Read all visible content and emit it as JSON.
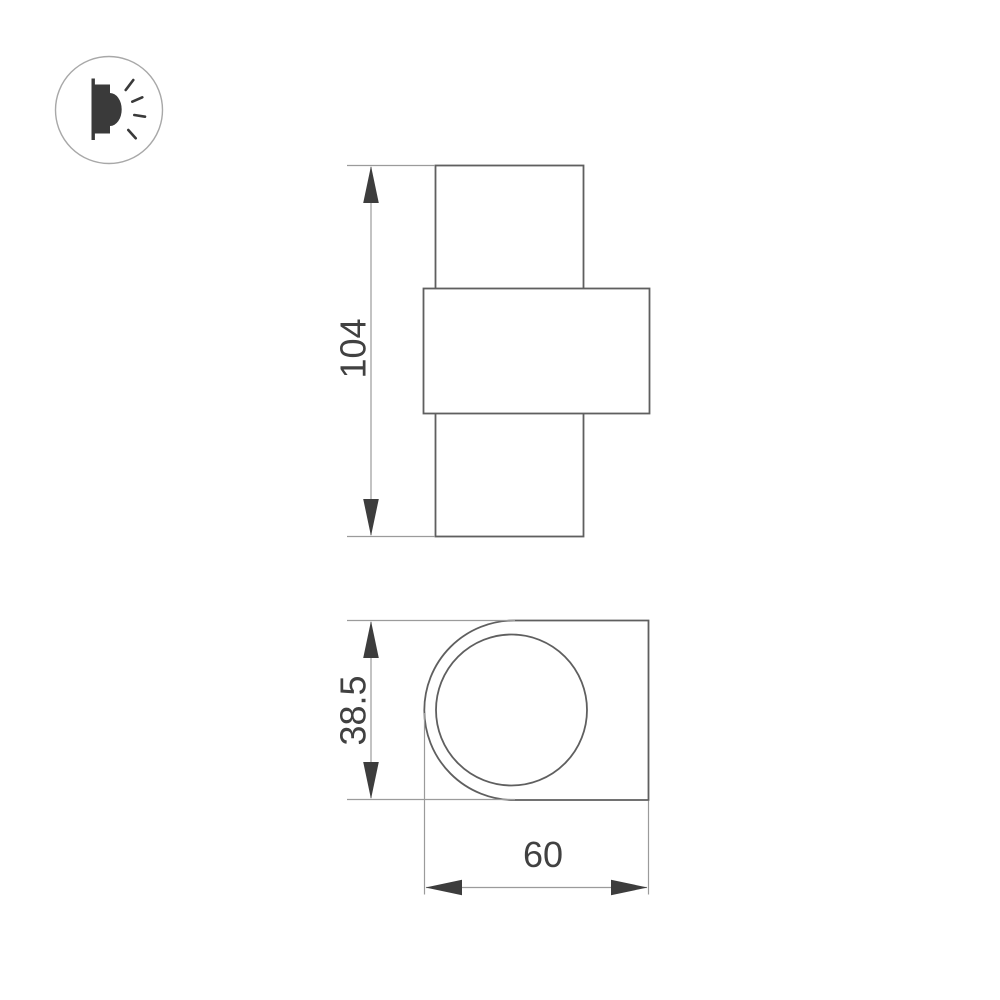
{
  "logo": {
    "icon": "wall-lamp-light-rays-icon"
  },
  "dimensions": {
    "front_height": "104",
    "top_depth": "38.5",
    "top_width": "60"
  },
  "colors": {
    "shape_outline": "#5f5f5f",
    "dimension_line": "#9b9b9b",
    "arrow": "#3d3d3d",
    "label_text": "#414141",
    "logo_circle": "#a8a8a8",
    "logo_glyph": "#3a3a3a"
  }
}
